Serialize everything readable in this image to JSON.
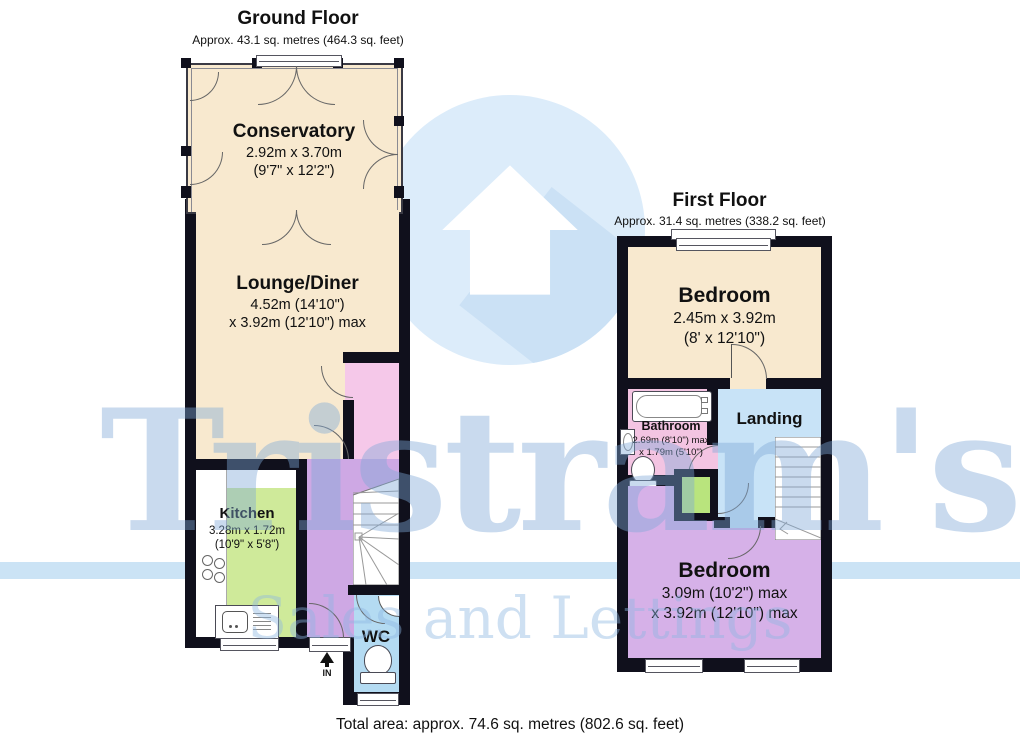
{
  "watermark": {
    "brand": "Tristram's",
    "tagline": "Sales and Lettings",
    "logo": "house-in-circle-icon",
    "colors": {
      "text_blue": "#7fa9d8",
      "circle_blue": "#dcecfa",
      "bar_blue": "#bedcf3"
    }
  },
  "ground_floor": {
    "title": "Ground Floor",
    "subtitle": "Approx. 43.1 sq. metres (464.3 sq. feet)",
    "rooms": {
      "conservatory": {
        "name": "Conservatory",
        "dim_metric": "2.92m x 3.70m",
        "dim_imperial": "(9'7\" x 12'2\")",
        "fill": "#f8e9cf"
      },
      "lounge_diner": {
        "name": "Lounge/Diner",
        "dim_metric": "4.52m (14'10\")",
        "dim_imperial": "x 3.92m (12'10\") max",
        "fill": "#f8e9cf"
      },
      "kitchen": {
        "name": "Kitchen",
        "dim_metric": "3.28m x 1.72m",
        "dim_imperial": "(10'9\" x 5'8\")",
        "fill": "#cfea9a"
      },
      "wc": {
        "name": "WC",
        "fill": "#b4dbf2"
      },
      "hall": {
        "fill": "#cea8e4"
      }
    },
    "entrance_label": "IN"
  },
  "first_floor": {
    "title": "First Floor",
    "subtitle": "Approx. 31.4 sq. metres (338.2 sq. feet)",
    "rooms": {
      "bedroom_front": {
        "name": "Bedroom",
        "dim_metric": "2.45m x 3.92m",
        "dim_imperial": "(8' x 12'10\")",
        "fill": "#f8e9cf"
      },
      "bathroom": {
        "name": "Bathroom",
        "dim_metric": "2.69m (8'10\") max",
        "dim_imperial": "x 1.79m (5'10\")",
        "fill": "#f3c4e2"
      },
      "landing": {
        "name": "Landing",
        "fill": "#c8e3f7"
      },
      "bedroom_back": {
        "name": "Bedroom",
        "dim_metric": "3.09m (10'2\") max",
        "dim_imperial": "x 3.92m (12'10\") max",
        "fill": "#d6b1e8"
      },
      "cupboard": {
        "fill": "#b9e47d"
      }
    }
  },
  "footer": {
    "total_area": "Total area: approx. 74.6 sq. metres (802.6 sq. feet)"
  },
  "palette": {
    "wall": "#10101c",
    "pink_hall": "#f5c8e9"
  }
}
